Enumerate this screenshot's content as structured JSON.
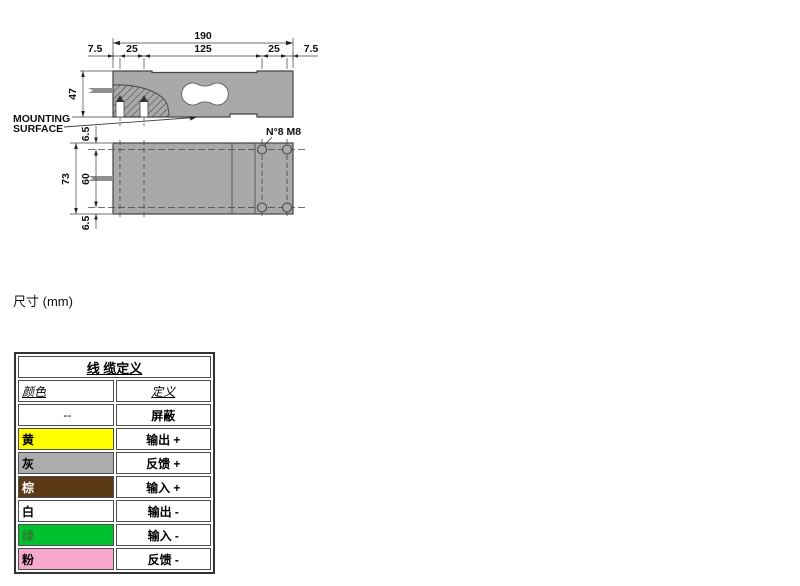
{
  "drawing": {
    "labels": {
      "total_width": "190",
      "chain": [
        "7.5",
        "25",
        "125",
        "25",
        "7.5"
      ],
      "side_height": "47",
      "offset_top": "6.5",
      "plate_height": "73",
      "holes_span": "60",
      "offset_bottom": "6.5",
      "mounting_line1": "MOUNTING",
      "mounting_line2": "SURFACE",
      "holes_note": "N°8 M8"
    },
    "colors": {
      "body": "#a9a9a9",
      "cable": "#8f8f8f",
      "line": "#3f3f3f"
    }
  },
  "caption": {
    "units_label": "尺寸 (mm)"
  },
  "cable_table": {
    "title": "线 缆定义",
    "col_color": "颜色",
    "col_definition": "定义",
    "rows": [
      {
        "color": "--",
        "definition": "屏蔽",
        "bg": "#ffffff",
        "fg": "#000000"
      },
      {
        "color": "黄",
        "definition": "输出 +",
        "bg": "#ffff00",
        "fg": "#000000"
      },
      {
        "color": "灰",
        "definition": "反馈 +",
        "bg": "#acacac",
        "fg": "#000000"
      },
      {
        "color": "棕",
        "definition": "输入 +",
        "bg": "#5d3a16",
        "fg": "#ffffff"
      },
      {
        "color": "白",
        "definition": "输出 -",
        "bg": "#ffffff",
        "fg": "#000000"
      },
      {
        "color": "绿",
        "definition": "输入 -",
        "bg": "#00c22e",
        "fg": "#2e7d2e"
      },
      {
        "color": "粉",
        "definition": "反馈 -",
        "bg": "#f9a8cd",
        "fg": "#000000"
      }
    ]
  }
}
